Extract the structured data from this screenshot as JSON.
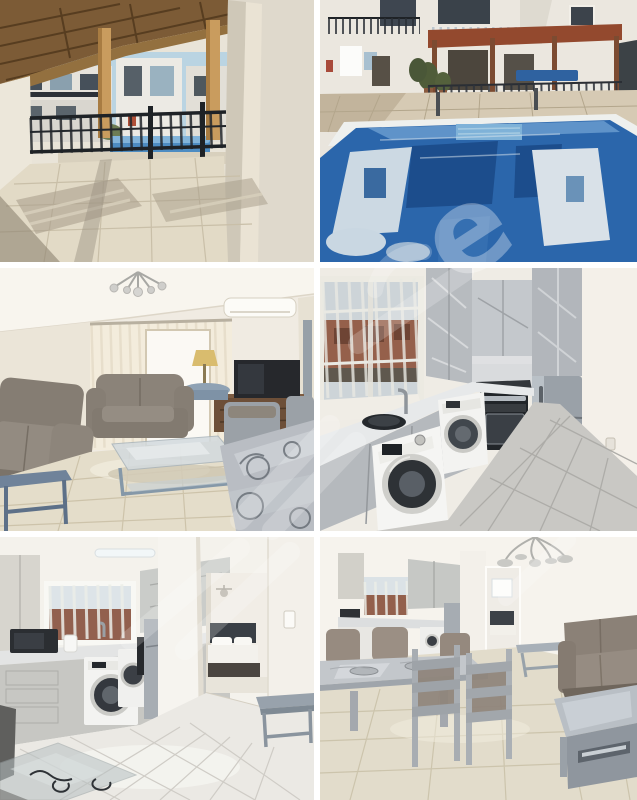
{
  "page": {
    "background": "#ffffff",
    "description": "Collage of six interior and exterior photos of an apartment, arranged in a 2x3 grid with white gaps"
  },
  "gallery": {
    "gap_px": 6,
    "photos": [
      {
        "id": "terrace",
        "label": "Covered veranda with wooden pergola, tiled floor, black railing and view of communal pool and apartment buildings"
      },
      {
        "id": "pool",
        "label": "Blue communal swimming pool with building reflections, pergola terrace and sun loungers behind"
      },
      {
        "id": "living-room",
        "label": "Living room with grey sofas, glass coffee table, TV on wooden stand, sheer curtains, chandelier and air conditioner"
      },
      {
        "id": "kitchen",
        "label": "Kitchen with marble-effect cabinets, barred window, sink, washing machine, built-in oven and stainless fridge"
      },
      {
        "id": "kitchen-hall",
        "label": "Kitchen with appliances and hallway column, open doorway to bedroom with double bed, glossy tiled floor and glass table"
      },
      {
        "id": "dining-area",
        "label": "Open-plan dining area with grey dining table and upholstered chairs, taupe sofa, grey coffee table and kitchen behind"
      }
    ]
  },
  "watermark": {
    "visible_letter": "e",
    "color": "#ffffff",
    "opacity": 0.32
  },
  "colors": {
    "pool_blue": "#2b66ab",
    "deck_beige": "#d6cab4",
    "pergola_wood": "#7c5b36",
    "sofa_taupe": "#857d73",
    "cabinet_marble": "#b7bbbf",
    "floor_cream": "#e2dac6",
    "floor_grey": "#c9c8c4",
    "gap_white": "#ffffff"
  }
}
